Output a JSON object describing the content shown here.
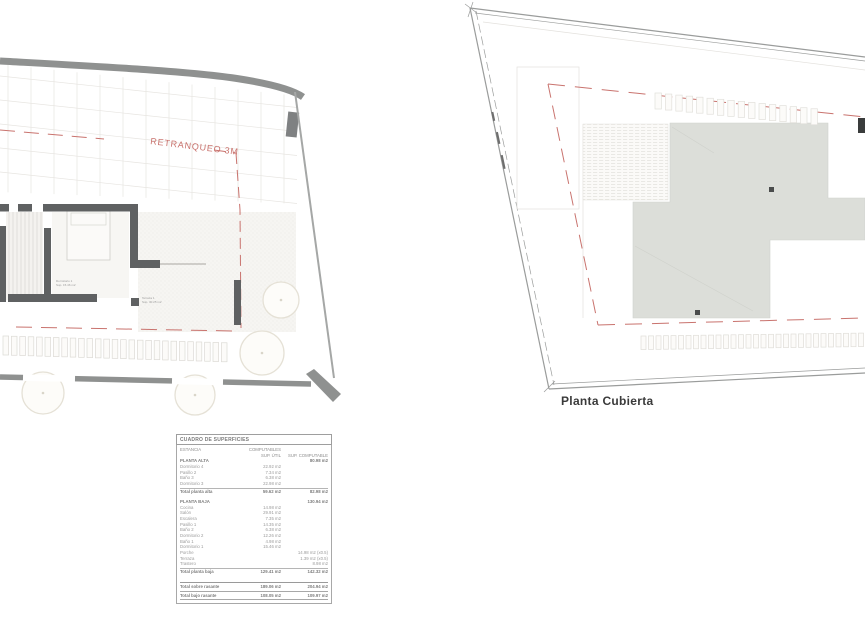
{
  "colors": {
    "wall_dark": "#5f6162",
    "band_gray": "#8f9190",
    "roof_fill": "#dcded9",
    "setback_red": "#c9736e",
    "faint_line": "#e4e2de",
    "tree_stroke": "#e5e1d6",
    "table_text": "#9b9b9b"
  },
  "left_plan": {
    "retranqueo_label": "RETRANQUEO 3M",
    "room_labels": [
      {
        "name": "Dormitorio 1",
        "area": "Sup. 15.46 m2"
      },
      {
        "name": "Terraza 1",
        "area": "Sup. 30.25 m2"
      }
    ]
  },
  "right_plan": {
    "caption": "Planta Cubierta"
  },
  "surface_table": {
    "title": "CUADRO DE SUPERFICIES",
    "col_left": "ESTANCIA",
    "col_right": "COMPUTABLES",
    "sub_col1": "SUP. ÚTIL",
    "sub_col2": "SUP. COMPUTABLE",
    "sections": [
      {
        "header": "PLANTA ALTA",
        "header_v2": "80.98 m2",
        "rows": [
          [
            "Dormitorio 4",
            "22.92 m2",
            ""
          ],
          [
            "Pasillo 2",
            "7.34 m2",
            ""
          ],
          [
            "Baño 3",
            "6.38 m2",
            ""
          ],
          [
            "Dormitorio 3",
            "22.98 m2",
            ""
          ]
        ],
        "total": [
          "Total planta alta",
          "59.62 m2",
          "82.98 m2"
        ]
      },
      {
        "header": "PLANTA BAJA",
        "header_v2": "130.94 m2",
        "rows": [
          [
            "Cocina",
            "14.98 m2",
            ""
          ],
          [
            "Salón",
            "29.91 m2",
            ""
          ],
          [
            "Escalera",
            "7.35 m2",
            ""
          ],
          [
            "Pasillo 1",
            "14.35 m2",
            ""
          ],
          [
            "Baño 2",
            "6.38 m2",
            ""
          ],
          [
            "Dormitorio 2",
            "12.26 m2",
            ""
          ],
          [
            "Baño 1",
            "4.98 m2",
            ""
          ],
          [
            "Dormitorio 1",
            "15.46 m2",
            ""
          ],
          [
            "Porche",
            "",
            "14.98 m2 (x0.5)"
          ],
          [
            "Terraza",
            "",
            "1.39 m2 (x0.5)"
          ],
          [
            "Trastero",
            "",
            "8.98 m2"
          ]
        ],
        "total": [
          "Total planta baja",
          "129.41 m2",
          "142.32 m2"
        ]
      }
    ],
    "grand_totals": [
      [
        "Total sobre rasante",
        "189.06 m2",
        "204.94 m2"
      ],
      [
        "Total bajo rasante",
        "108.05 m2",
        "109.97 m2"
      ]
    ]
  }
}
